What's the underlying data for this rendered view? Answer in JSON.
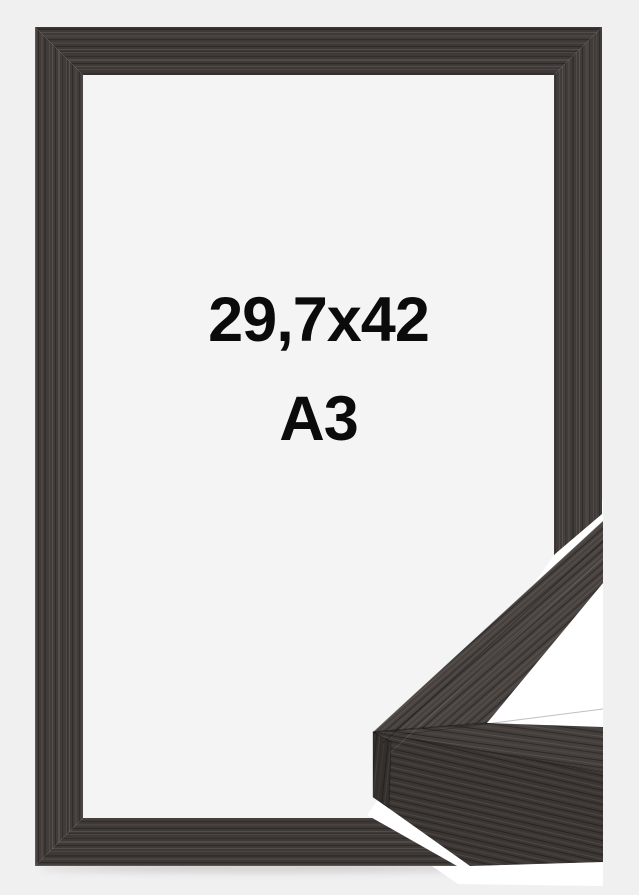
{
  "product": {
    "size_label": "29,7x42",
    "format_label": "A3"
  },
  "colors": {
    "page_background": "#f0f0f1",
    "frame_wood": "#3e3936",
    "frame_opening": "#f4f4f5",
    "detail_backdrop": "#ffffff",
    "label_text": "#0b0b0b"
  }
}
